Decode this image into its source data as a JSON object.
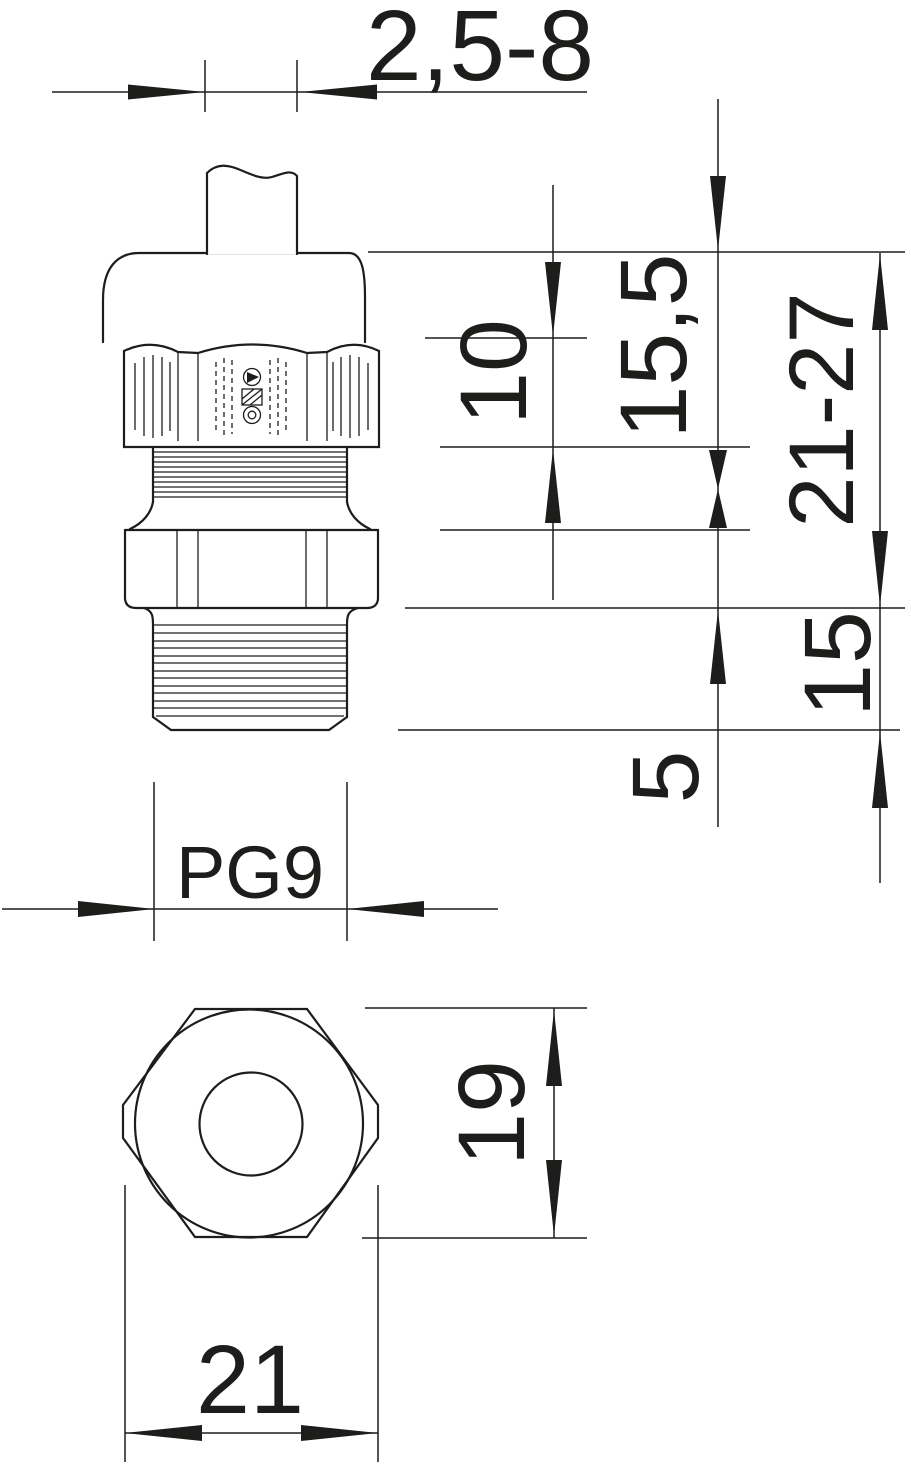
{
  "drawing": {
    "kind": "cable-gland dimension drawing",
    "line_color": "#1d1d1b",
    "background_color": "#ffffff",
    "dimensions": {
      "clamping_range": "2,5-8",
      "hex_height": "10",
      "cap_height": "15,5",
      "overall_length": "21-27",
      "thread_length": "15",
      "collar_height": "5",
      "thread_size": "PG9",
      "width_across_flats": "19",
      "width_across_corners": "21"
    }
  }
}
